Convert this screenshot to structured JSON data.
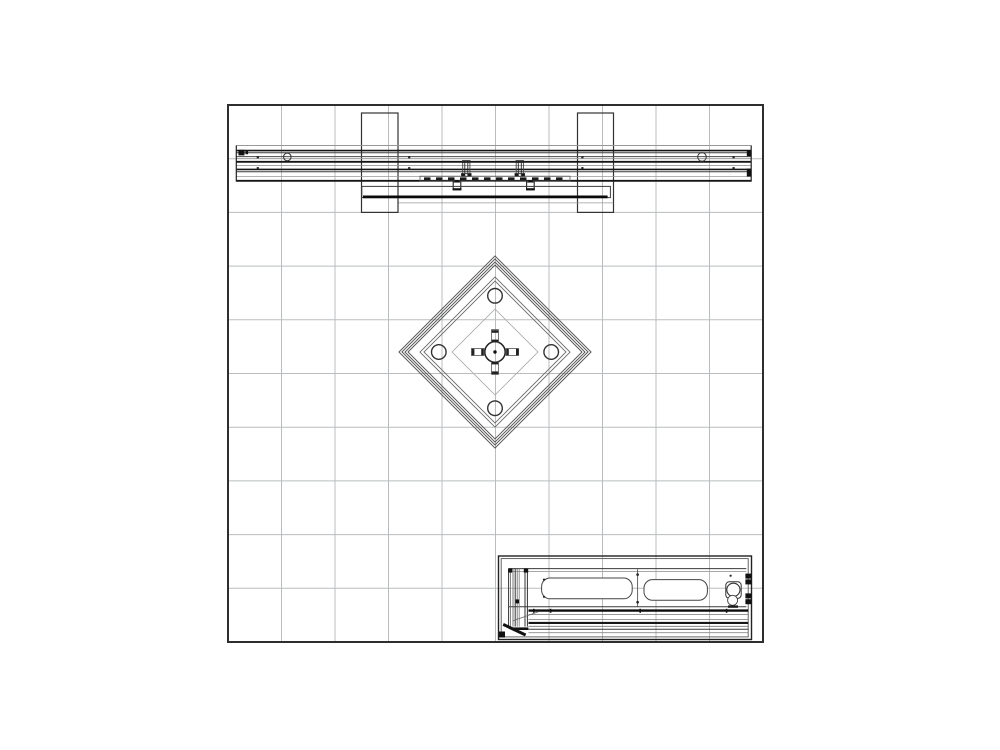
{
  "document": {
    "type": "cad-plan-drawing",
    "description": "Black-and-white CAD top-view plan of an exhibit booth: back wall beam with two support plates (top), rotated square tower with four post circles and center column connector (middle), rectangular counter cabinet with slots, grommet and corner bracket (bottom right), all over a 10x10 floor grid.",
    "background_color": "#ffffff"
  },
  "colors": {
    "grid_line": "#b9bdbf",
    "boundary": "#2e2e2e",
    "line_dark": "#141414",
    "line_mid": "#3a3a3a",
    "line_light": "#8f9396",
    "white_fill": "#ffffff"
  },
  "grid": {
    "x": 228,
    "y": 105,
    "width": 535,
    "height": 537,
    "cols": 10,
    "rows": 10
  },
  "components": {
    "boundary": {
      "label": "booth floor boundary",
      "x": 228,
      "y": 105,
      "width": 535,
      "height": 537
    },
    "beam": {
      "label": "back wall beam plan",
      "extent_x": [
        236,
        751.5
      ],
      "extent_y": [
        145.5,
        181
      ],
      "supports": 2,
      "end_circles": 2,
      "center_posts": 2
    },
    "tower": {
      "label": "rotated tower plan",
      "center": [
        495,
        352
      ],
      "ring_half_diagonals": [
        96,
        93,
        90,
        87,
        75,
        71,
        43
      ],
      "corner_circle_distance": 56,
      "corner_circle_radius": 7.3,
      "hub_radius": 10.2
    },
    "counter": {
      "label": "counter cabinet plan",
      "x": 498.5,
      "y": 556,
      "width": 253,
      "height": 83.5,
      "slots": 2,
      "grommet": 1
    }
  }
}
